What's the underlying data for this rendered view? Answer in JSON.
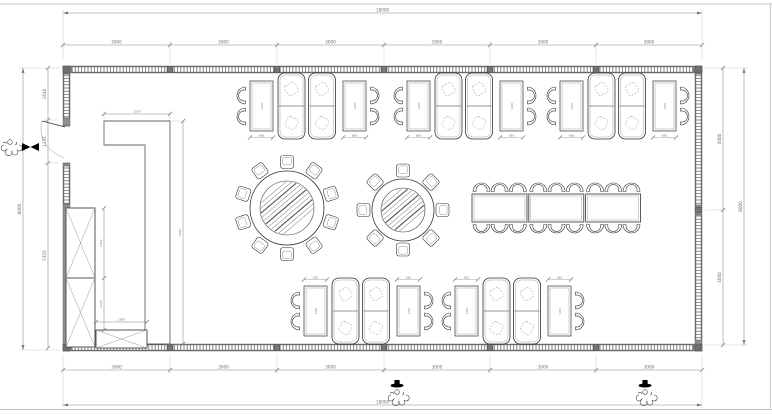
{
  "sheet": {
    "w": 772,
    "h": 414,
    "border_color": "#c4c4c4",
    "bg": "#ffffff"
  },
  "palette": {
    "wall_fill": "#8f8f8f",
    "wall_edge": "#555555",
    "line_dark": "#333333",
    "line_mid": "#666666",
    "dim_line": "#888888",
    "text_dim": "#707070",
    "mullion_fill": "#757575"
  },
  "walls": {
    "x1": 63,
    "y1": 66,
    "x2": 702,
    "y2": 351,
    "t": 7,
    "mullions_x": [
      170,
      277,
      384,
      490,
      596
    ],
    "right_mullion_y": 210,
    "left_bands": [
      [
        74,
        118
      ],
      [
        166,
        204
      ]
    ],
    "right_bands": [
      [
        74,
        205
      ],
      [
        215,
        340
      ]
    ],
    "door": {
      "y1": 126,
      "y2": 163
    }
  },
  "dimensions": {
    "top": {
      "overall": {
        "y": 13,
        "label": "18000"
      },
      "chain": {
        "y": 45,
        "ticks": [
          63,
          170,
          277,
          384,
          490,
          596,
          702
        ],
        "labels": [
          "3000",
          "3000",
          "3000",
          "3000",
          "3000",
          "3000"
        ]
      }
    },
    "bottom": {
      "overall": {
        "y": 405,
        "label": "18000"
      },
      "chain": {
        "y": 370,
        "ticks": [
          63,
          170,
          277,
          384,
          490,
          596,
          702
        ],
        "labels": [
          "3000",
          "3000",
          "3000",
          "3000",
          "3000",
          "3000"
        ]
      }
    },
    "left": {
      "overall": {
        "x": 23,
        "label": "8000"
      },
      "chain": {
        "x": 48,
        "ticks": [
          68,
          120,
          163,
          348
        ],
        "labels": [
          "1640",
          "1135",
          "5325"
        ]
      }
    },
    "right": {
      "overall": {
        "x": 744,
        "label": "8000"
      },
      "chain": {
        "x": 723,
        "ticks": [
          68,
          210,
          345
        ],
        "labels": [
          "4000",
          "4000"
        ]
      }
    },
    "partition": {
      "top": {
        "y": 114,
        "x1": 104,
        "x2": 170,
        "label": "1500"
      },
      "side": {
        "x": 183,
        "y1": 121,
        "y2": 344,
        "label": "6300"
      }
    },
    "cabinet": {
      "side": {
        "x": 104,
        "ticks": [
          208,
          278,
          330
        ],
        "labels": [
          "2120",
          "2005"
        ]
      },
      "box": {
        "y": 322,
        "x1": 96,
        "x2": 147,
        "label": "1500"
      }
    },
    "booth_table": {
      "length_label": "1200",
      "width_label": "650"
    }
  },
  "partition_outline": [
    [
      104,
      121
    ],
    [
      170,
      121
    ],
    [
      170,
      344
    ],
    [
      145,
      344
    ],
    [
      145,
      145
    ],
    [
      104,
      145
    ]
  ],
  "cabinets": {
    "tall": {
      "x": 66,
      "y": 208,
      "w": 29,
      "h": 139,
      "divider_y": 278
    },
    "box": {
      "x": 96,
      "y": 330,
      "w": 51,
      "h": 18
    }
  },
  "furniture": {
    "booth_groups": {
      "top": {
        "cy": 106,
        "xs": [
          233,
          390,
          543
        ],
        "dim_side": 1
      },
      "bottom": {
        "cy": 311,
        "xs": [
          287,
          438
        ],
        "dim_side": -1
      }
    },
    "round_tables": [
      {
        "cx": 287,
        "cy": 208,
        "r_out": 37,
        "r_in": 27,
        "chairs": 10,
        "chair_dist": 46
      },
      {
        "cx": 403,
        "cy": 210,
        "r_out": 31,
        "r_in": 22,
        "chairs": 8,
        "chair_dist": 39.5
      }
    ],
    "banquet": {
      "x": 472,
      "y": 194,
      "table_w": 55,
      "table_h": 28,
      "count": 3,
      "gap": 1.8,
      "chairs_per_side": 3
    }
  },
  "figures": [
    {
      "type": "door-person",
      "x": 10,
      "y": 148
    },
    {
      "type": "marker-bowtie",
      "x": 31,
      "y": 147
    },
    {
      "type": "walking-person",
      "x": 397,
      "y": 398
    },
    {
      "type": "marker-hat",
      "x": 397,
      "y": 384
    },
    {
      "type": "walking-person",
      "x": 645,
      "y": 398
    },
    {
      "type": "marker-hat",
      "x": 645,
      "y": 384
    }
  ]
}
